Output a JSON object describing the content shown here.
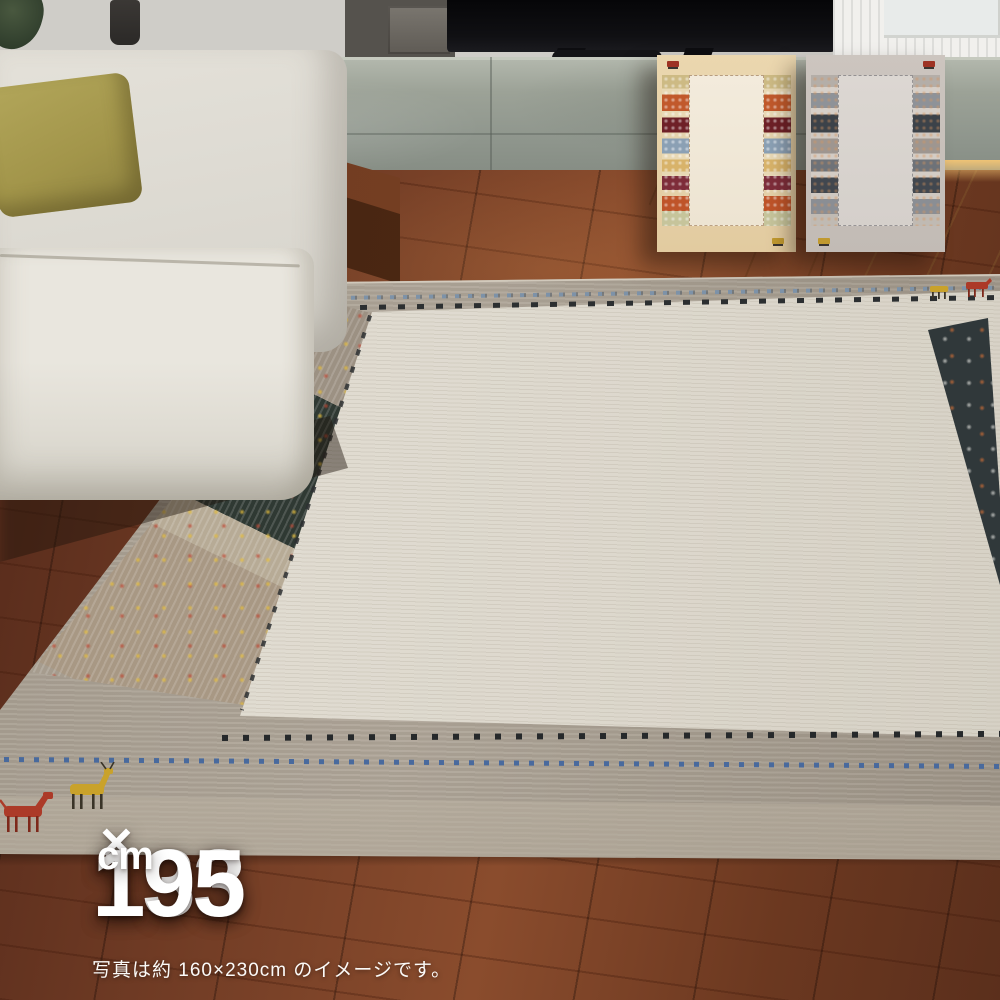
{
  "size_label": {
    "width": "133",
    "times": "×",
    "height": "195",
    "unit": "cm"
  },
  "caption": "写真は約 160×230cm のイメージです。",
  "origin_flag": {
    "country": "Belgium",
    "colors": {
      "black": "#131313",
      "yellow": "#F6D21D",
      "red": "#EE3D48"
    }
  },
  "variants": [
    {
      "name": "beige",
      "field_color": "#F2EADB",
      "border_color": "#E7D3A9"
    },
    {
      "name": "gray",
      "field_color": "#DBD6D1",
      "border_color": "#C7C0BA"
    }
  ],
  "main_rug": {
    "field_color": "#E0DCD2",
    "border_color": "#A89F92",
    "accent_colors": [
      "#44679E",
      "#26292B",
      "#C9A22B",
      "#AC3A28"
    ]
  }
}
